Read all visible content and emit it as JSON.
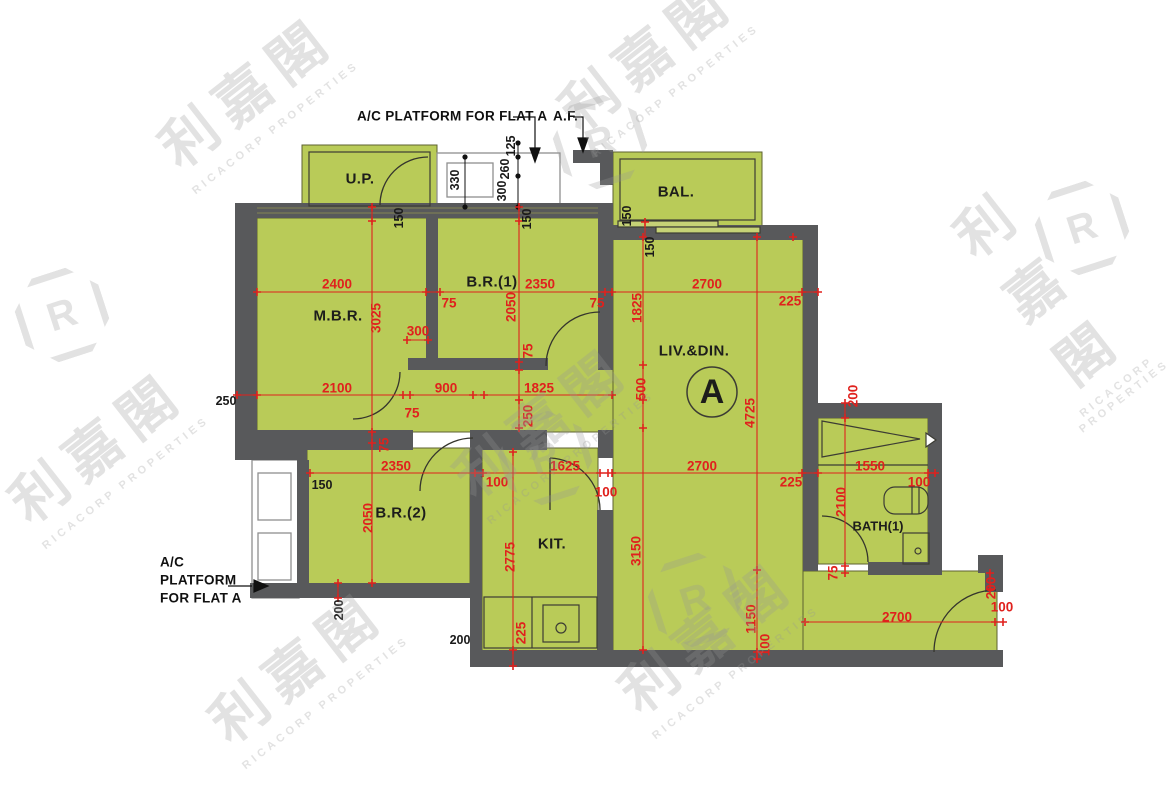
{
  "watermark": {
    "cjk": "利嘉閣",
    "en": "RICACORP PROPERTIES",
    "logo_letter": "R"
  },
  "flat": {
    "unit_label": "A"
  },
  "labels": [
    {
      "t": "A/C PLATFORM FOR FLAT A",
      "x": 357,
      "y": 116,
      "k": "notel",
      "n": "ac-platform-top-label"
    },
    {
      "t": "A.F.",
      "x": 553,
      "y": 116,
      "k": "notel",
      "n": "af-label"
    },
    {
      "t": "A/C",
      "x": 160,
      "y": 562,
      "k": "notel",
      "n": "ac-platform-left-label-1"
    },
    {
      "t": "PLATFORM",
      "x": 160,
      "y": 580,
      "k": "notel",
      "n": "ac-platform-left-label-2"
    },
    {
      "t": "FOR FLAT A",
      "x": 160,
      "y": 598,
      "k": "notel",
      "n": "ac-platform-left-label-3"
    },
    {
      "t": "U.P.",
      "x": 360,
      "y": 179,
      "k": "room",
      "n": "room-up"
    },
    {
      "t": "BAL.",
      "x": 676,
      "y": 192,
      "k": "room",
      "n": "room-bal"
    },
    {
      "t": "M.B.R.",
      "x": 338,
      "y": 316,
      "k": "room",
      "n": "room-mbr"
    },
    {
      "t": "B.R.(1)",
      "x": 492,
      "y": 282,
      "k": "room",
      "n": "room-br1"
    },
    {
      "t": "B.R.(2)",
      "x": 401,
      "y": 513,
      "k": "room",
      "n": "room-br2"
    },
    {
      "t": "KIT.",
      "x": 552,
      "y": 544,
      "k": "room",
      "n": "room-kit"
    },
    {
      "t": "LIV.&DIN.",
      "x": 694,
      "y": 351,
      "k": "room",
      "n": "room-livdin"
    },
    {
      "t": "BATH(1)",
      "x": 878,
      "y": 526,
      "k": "room2",
      "n": "room-bath1"
    },
    {
      "t": "A",
      "x": 712,
      "y": 392,
      "k": "big",
      "n": "flat-letter"
    },
    {
      "t": "250",
      "x": 226,
      "y": 401,
      "k": "ink",
      "n": "dim-250"
    },
    {
      "t": "150",
      "x": 322,
      "y": 485,
      "k": "ink",
      "n": "dim-150-br2"
    },
    {
      "t": "200",
      "x": 460,
      "y": 640,
      "k": "ink",
      "n": "dim-200-kit"
    },
    {
      "t": "150",
      "x": 399,
      "y": 218,
      "k": "inkv",
      "n": "dim-150-up"
    },
    {
      "t": "150",
      "x": 527,
      "y": 219,
      "k": "inkv",
      "n": "dim-150-br1"
    },
    {
      "t": "150",
      "x": 627,
      "y": 216,
      "k": "inkv",
      "n": "dim-150-bal1"
    },
    {
      "t": "150",
      "x": 650,
      "y": 247,
      "k": "inkv",
      "n": "dim-150-bal2"
    },
    {
      "t": "330",
      "x": 455,
      "y": 180,
      "k": "inkv",
      "n": "dim-330-platform"
    },
    {
      "t": "125",
      "x": 511,
      "y": 146,
      "k": "inkv",
      "n": "dim-125-platform"
    },
    {
      "t": "260",
      "x": 505,
      "y": 169,
      "k": "inkv",
      "n": "dim-260-platform"
    },
    {
      "t": "300",
      "x": 502,
      "y": 191,
      "k": "inkv",
      "n": "dim-300-platform"
    },
    {
      "t": "200",
      "x": 339,
      "y": 610,
      "k": "inkv",
      "n": "dim-200-br2-wall"
    },
    {
      "t": "2400",
      "x": 337,
      "y": 284,
      "k": "dim",
      "n": "dim-2400-mbr"
    },
    {
      "t": "2350",
      "x": 540,
      "y": 284,
      "k": "dim",
      "n": "dim-2350-br1"
    },
    {
      "t": "2700",
      "x": 707,
      "y": 284,
      "k": "dim",
      "n": "dim-2700-liv-top"
    },
    {
      "t": "225",
      "x": 790,
      "y": 301,
      "k": "dim",
      "n": "dim-225-top"
    },
    {
      "t": "75",
      "x": 449,
      "y": 303,
      "k": "dim",
      "n": "dim-75-top1"
    },
    {
      "t": "75",
      "x": 597,
      "y": 303,
      "k": "dim",
      "n": "dim-75-top2"
    },
    {
      "t": "2100",
      "x": 337,
      "y": 388,
      "k": "dim",
      "n": "dim-2100-mbr"
    },
    {
      "t": "900",
      "x": 446,
      "y": 388,
      "k": "dim",
      "n": "dim-900-hall"
    },
    {
      "t": "1825",
      "x": 539,
      "y": 388,
      "k": "dim",
      "n": "dim-1825-hall"
    },
    {
      "t": "75",
      "x": 412,
      "y": 413,
      "k": "dim",
      "n": "dim-75-mid"
    },
    {
      "t": "300",
      "x": 418,
      "y": 331,
      "k": "dim",
      "n": "dim-300-mbr"
    },
    {
      "t": "2350",
      "x": 396,
      "y": 466,
      "k": "dim",
      "n": "dim-2350-br2"
    },
    {
      "t": "100",
      "x": 497,
      "y": 482,
      "k": "dim",
      "n": "dim-100-br2"
    },
    {
      "t": "1625",
      "x": 565,
      "y": 466,
      "k": "dim",
      "n": "dim-1625-kit"
    },
    {
      "t": "100",
      "x": 606,
      "y": 492,
      "k": "dim",
      "n": "dim-100-kit"
    },
    {
      "t": "2700",
      "x": 702,
      "y": 466,
      "k": "dim",
      "n": "dim-2700-liv-mid"
    },
    {
      "t": "225",
      "x": 791,
      "y": 482,
      "k": "dim",
      "n": "dim-225-mid"
    },
    {
      "t": "1550",
      "x": 870,
      "y": 466,
      "k": "dim",
      "n": "dim-1550-bath"
    },
    {
      "t": "100",
      "x": 919,
      "y": 482,
      "k": "dim",
      "n": "dim-100-bath"
    },
    {
      "t": "2700",
      "x": 897,
      "y": 617,
      "k": "dim",
      "n": "dim-2700-foyer"
    },
    {
      "t": "100",
      "x": 1002,
      "y": 607,
      "k": "dim",
      "n": "dim-100-foyer"
    },
    {
      "t": "3025",
      "x": 376,
      "y": 318,
      "k": "dimv",
      "n": "dim-3025-mbr"
    },
    {
      "t": "2050",
      "x": 511,
      "y": 307,
      "k": "dimv",
      "n": "dim-2050-br1"
    },
    {
      "t": "75",
      "x": 528,
      "y": 351,
      "k": "dimv",
      "n": "dim-75-br1wall"
    },
    {
      "t": "250",
      "x": 528,
      "y": 416,
      "k": "dimv",
      "n": "dim-250-hall"
    },
    {
      "t": "1825",
      "x": 637,
      "y": 308,
      "k": "dimv",
      "n": "dim-1825-liv"
    },
    {
      "t": "500",
      "x": 641,
      "y": 389,
      "k": "dimv",
      "n": "dim-500-liv"
    },
    {
      "t": "3150",
      "x": 636,
      "y": 551,
      "k": "dimv",
      "n": "dim-3150-liv"
    },
    {
      "t": "4725",
      "x": 750,
      "y": 413,
      "k": "dimv",
      "n": "dim-4725-liv"
    },
    {
      "t": "2775",
      "x": 510,
      "y": 557,
      "k": "dimv",
      "n": "dim-2775-kit"
    },
    {
      "t": "2050",
      "x": 368,
      "y": 518,
      "k": "dimv",
      "n": "dim-2050-br2"
    },
    {
      "t": "225",
      "x": 521,
      "y": 633,
      "k": "dimv",
      "n": "dim-225-kit"
    },
    {
      "t": "2100",
      "x": 841,
      "y": 502,
      "k": "dimv",
      "n": "dim-2100-bath"
    },
    {
      "t": "75",
      "x": 833,
      "y": 573,
      "k": "dimv",
      "n": "dim-75-bath"
    },
    {
      "t": "200",
      "x": 853,
      "y": 396,
      "k": "dimv",
      "n": "dim-200-bath-top"
    },
    {
      "t": "200",
      "x": 991,
      "y": 588,
      "k": "dimv",
      "n": "dim-200-entry"
    },
    {
      "t": "1150",
      "x": 751,
      "y": 619,
      "k": "dimv",
      "n": "dim-1150-foyer"
    },
    {
      "t": "100",
      "x": 765,
      "y": 645,
      "k": "dimv",
      "n": "dim-100-foyer-wall"
    },
    {
      "t": "75",
      "x": 384,
      "y": 445,
      "k": "dimv",
      "n": "dim-75-br2wall"
    }
  ]
}
